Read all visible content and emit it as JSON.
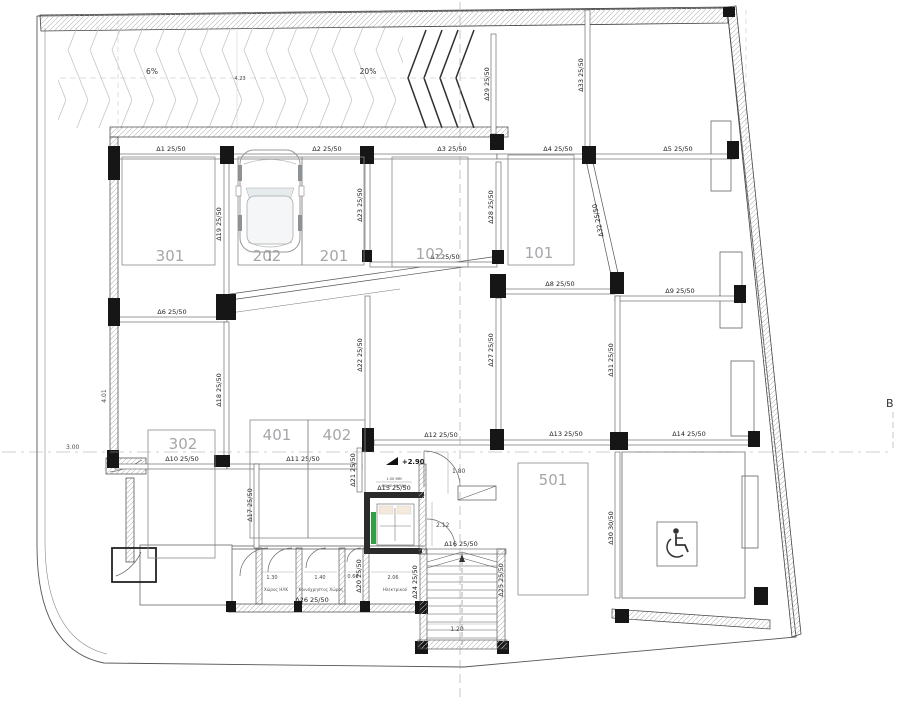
{
  "plan": {
    "section_label": "B",
    "level_mark": "+2.90"
  },
  "ramp": {
    "slope_gentle": "6%",
    "slope_steep": "20%",
    "width": "4.23"
  },
  "spaces": {
    "s301": "301",
    "s202": "202",
    "s201": "201",
    "s102": "102",
    "s101": "101",
    "s302": "302",
    "s401": "401",
    "s402": "402",
    "s501": "501"
  },
  "beams": {
    "d1": "Δ1 25/50",
    "d2": "Δ2 25/50",
    "d3": "Δ3 25/50",
    "d4": "Δ4 25/50",
    "d5": "Δ5 25/50",
    "d6": "Δ6 25/50",
    "d7": "Δ7 25/50",
    "d8": "Δ8 25/50",
    "d9": "Δ9 25/50",
    "d10": "Δ10 25/50",
    "d11": "Δ11 25/50",
    "d12": "Δ12 25/50",
    "d13": "Δ13 25/50",
    "d14": "Δ14 25/50",
    "d15": "Δ15 25/50",
    "d16": "Δ16 25/50",
    "d17": "Δ17 25/50",
    "d18": "Δ18 25/50",
    "d19": "Δ19 25/50",
    "d20": "Δ20 25/50",
    "d21": "Δ21 25/50",
    "d22": "Δ22 25/50",
    "d23": "Δ23 25/50",
    "d24": "Δ24 25/50",
    "d25": "Δ25 25/50",
    "d26": "Δ26 25/50",
    "d27": "Δ27 25/50",
    "d28": "Δ28 25/50",
    "d29": "Δ29 25/50",
    "d30": "Δ30 30/50",
    "d31": "Δ31 25/50",
    "d32": "Δ32 25/50",
    "d33": "Δ33 25/50"
  },
  "dimensions": {
    "plot_left": "4.01",
    "offset_left": "3.00",
    "ramp_width": "4.23",
    "lobby_width": "1.80",
    "corridor": "2.12",
    "stair_width": "1.20",
    "room_a": "1.30",
    "room_b": "1.40",
    "room_c": "0.66",
    "room_d": "2.06"
  },
  "rooms": {
    "elec_cab": "Χώρος ΗΛΚ",
    "shared": "Κοινόχρηστος Χώρος",
    "electrical": "Ηλεκτρικού"
  },
  "elevator": {
    "spec1": "1.50 ΜΜ",
    "spec2": "ΘΕ ΔΕ 90/75Α"
  },
  "colors": {
    "column": "#161616",
    "wall_hatch": "#b5b5b5",
    "green_door": "#2fa043",
    "line": "#444444"
  }
}
